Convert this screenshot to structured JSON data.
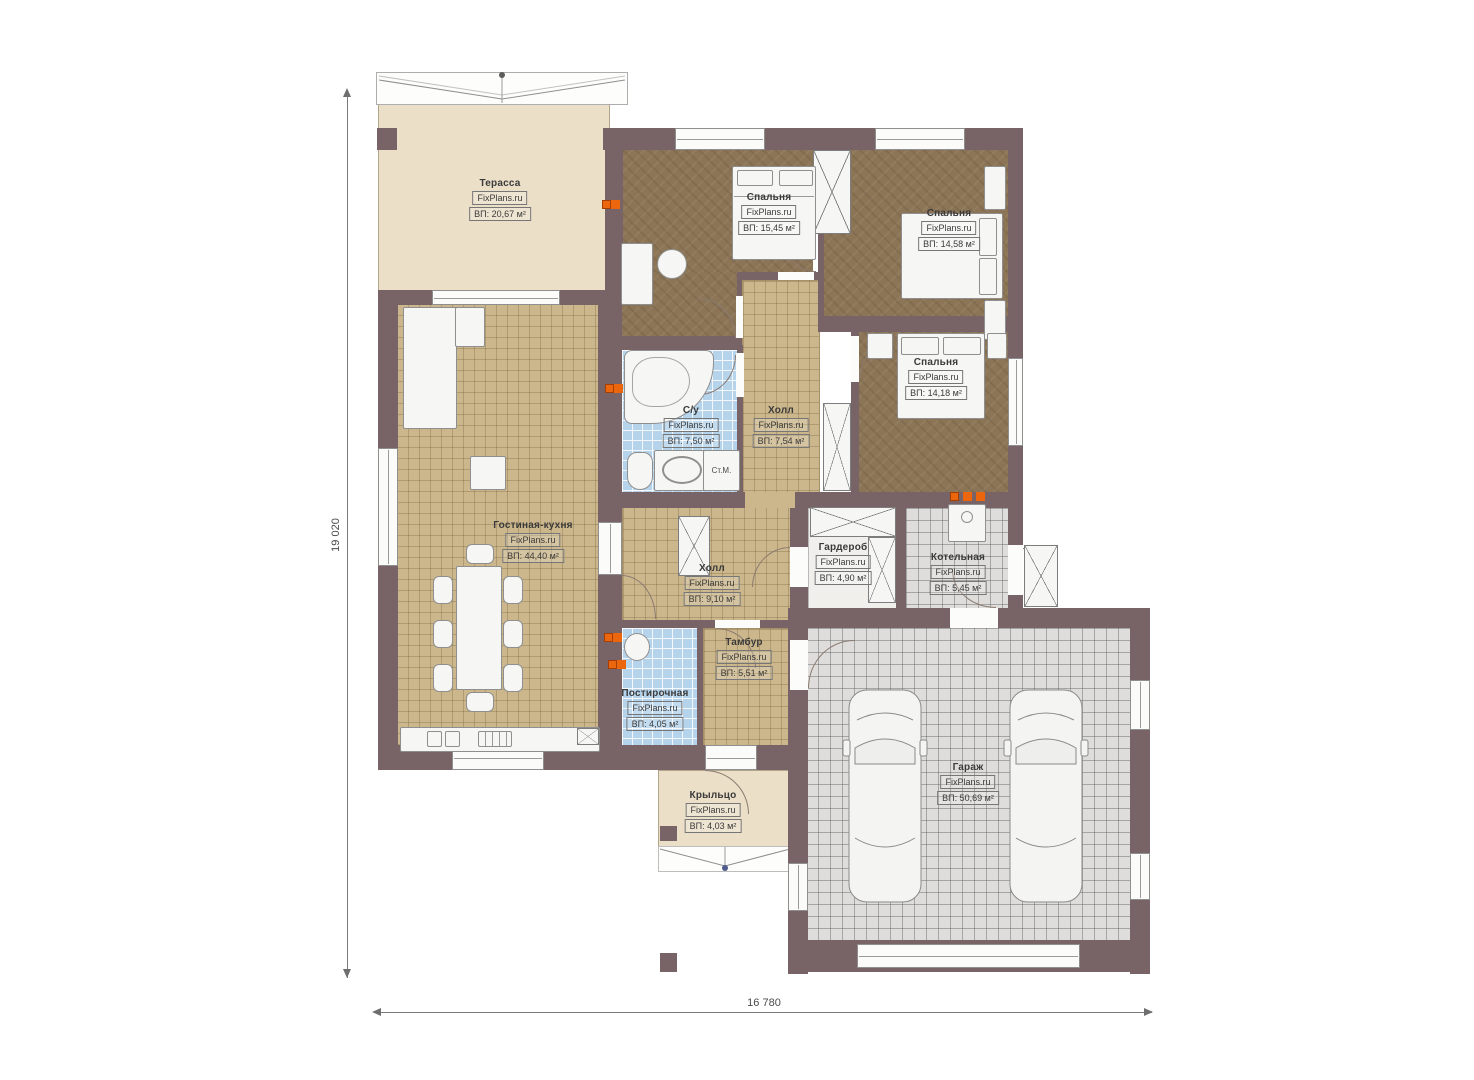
{
  "plan": {
    "brand_watermark": "FixPlans.ru",
    "dimensions": {
      "vertical": "19 020",
      "horizontal": "16 780"
    },
    "rooms": [
      {
        "key": "terrace",
        "name": "Терасса",
        "area": "ВП: 20,67 м²"
      },
      {
        "key": "bedroom-1",
        "name": "Спальня",
        "area": "ВП: 15,45 м²"
      },
      {
        "key": "bedroom-2",
        "name": "Спальня",
        "area": "ВП: 14,58 м²"
      },
      {
        "key": "bedroom-3",
        "name": "Спальня",
        "area": "ВП: 14,18 м²"
      },
      {
        "key": "bathroom",
        "name": "С/у",
        "area": "ВП: 7,50 м²"
      },
      {
        "key": "hall-upper",
        "name": "Холл",
        "area": "ВП: 7,54 м²"
      },
      {
        "key": "living-kitchen",
        "name": "Гостиная-кухня",
        "area": "ВП: 44,40 м²"
      },
      {
        "key": "hall-lower",
        "name": "Холл",
        "area": "ВП: 9,10 м²"
      },
      {
        "key": "wardrobe",
        "name": "Гардероб",
        "area": "ВП: 4,90 м²"
      },
      {
        "key": "boiler-room",
        "name": "Котельная",
        "area": "ВП: 5,45 м²"
      },
      {
        "key": "vestibule",
        "name": "Тамбур",
        "area": "ВП: 5,51 м²"
      },
      {
        "key": "laundry",
        "name": "Постирочная",
        "area": "ВП: 4,05 м²"
      },
      {
        "key": "porch",
        "name": "Крыльцо",
        "area": "ВП: 4,03 м²"
      },
      {
        "key": "garage",
        "name": "Гараж",
        "area": "ВП: 50,69 м²"
      }
    ],
    "annotations": {
      "washing_machine": "Ст.М."
    },
    "colors": {
      "wall": "#786466",
      "bedroom_floor": "#8c7556",
      "tile_tan": "#ccb78d",
      "tile_blue": "#b6d3ec",
      "tile_gray": "#dedddb",
      "terrace_beige": "#ebdfc8",
      "marker_orange": "#ec660e"
    }
  }
}
